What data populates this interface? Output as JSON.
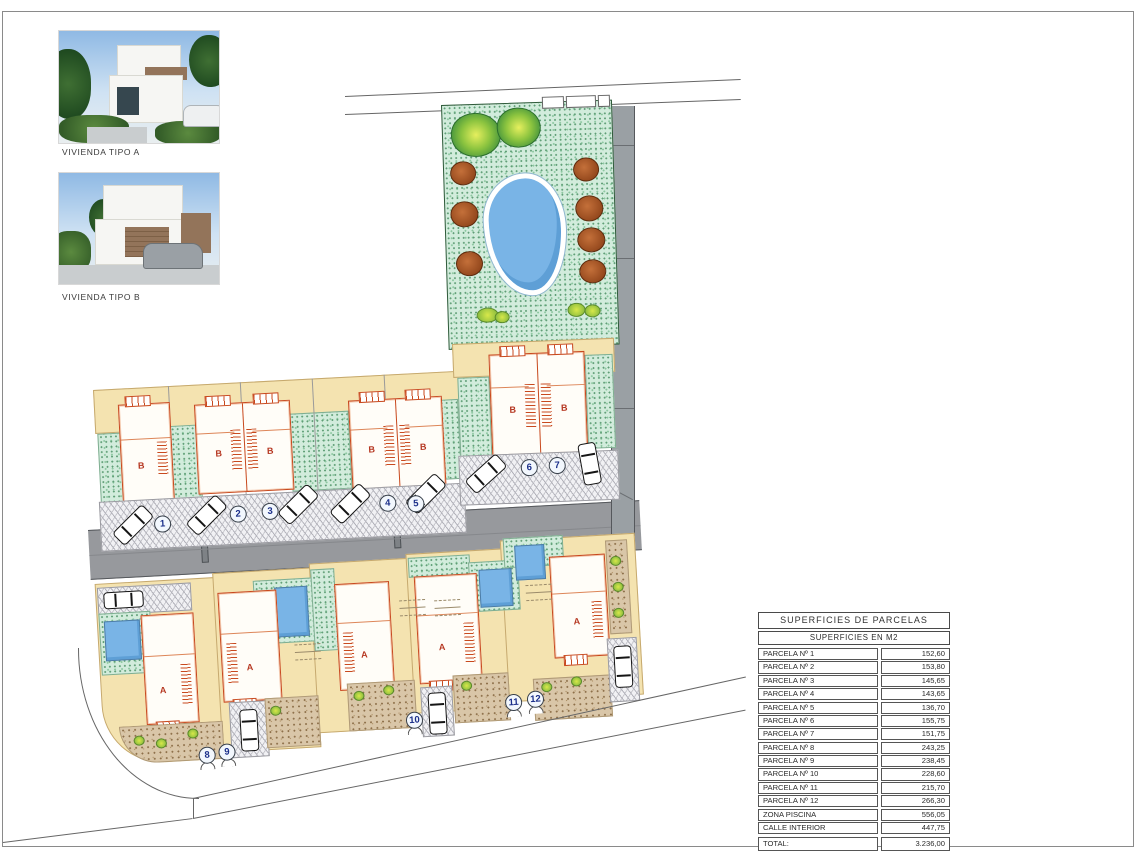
{
  "photos": {
    "a": {
      "label": "VIVIENDA TIPO A"
    },
    "b": {
      "label": "VIVIENDA TIPO B"
    }
  },
  "plan": {
    "house_labels": {
      "type_a": "A",
      "type_b": "B"
    },
    "parcel_badges": [
      "1",
      "2",
      "3",
      "4",
      "5",
      "6",
      "7",
      "8",
      "9",
      "10",
      "11",
      "12"
    ]
  },
  "table": {
    "title": "SUPERFICIES DE PARCELAS",
    "subtitle": "SUPERFICIES EN M2",
    "rows": [
      {
        "label": "PARCELA Nº 1",
        "value": "152,60"
      },
      {
        "label": "PARCELA Nº 2",
        "value": "153,80"
      },
      {
        "label": "PARCELA Nº 3",
        "value": "145,65"
      },
      {
        "label": "PARCELA Nº 4",
        "value": "143,65"
      },
      {
        "label": "PARCELA Nº 5",
        "value": "136,70"
      },
      {
        "label": "PARCELA Nº 6",
        "value": "155,75"
      },
      {
        "label": "PARCELA Nº 7",
        "value": "151,75"
      },
      {
        "label": "PARCELA Nº 8",
        "value": "243,25"
      },
      {
        "label": "PARCELA Nº 9",
        "value": "238,45"
      },
      {
        "label": "PARCELA Nº 10",
        "value": "228,60"
      },
      {
        "label": "PARCELA Nº 11",
        "value": "215,70"
      },
      {
        "label": "PARCELA Nº 12",
        "value": "266,30"
      },
      {
        "label": "ZONA PISCINA",
        "value": "556,05"
      },
      {
        "label": "CALLE INTERIOR",
        "value": "447,75"
      }
    ],
    "total": {
      "label": "TOTAL:",
      "value": "3.236,00"
    }
  },
  "colors": {
    "grass": "#d2ecdc",
    "sand": "#f4e3b0",
    "road": "#97999d",
    "pool": "#79b4e6",
    "house_outline": "#c8491e",
    "paving": "#d9c6a8"
  }
}
